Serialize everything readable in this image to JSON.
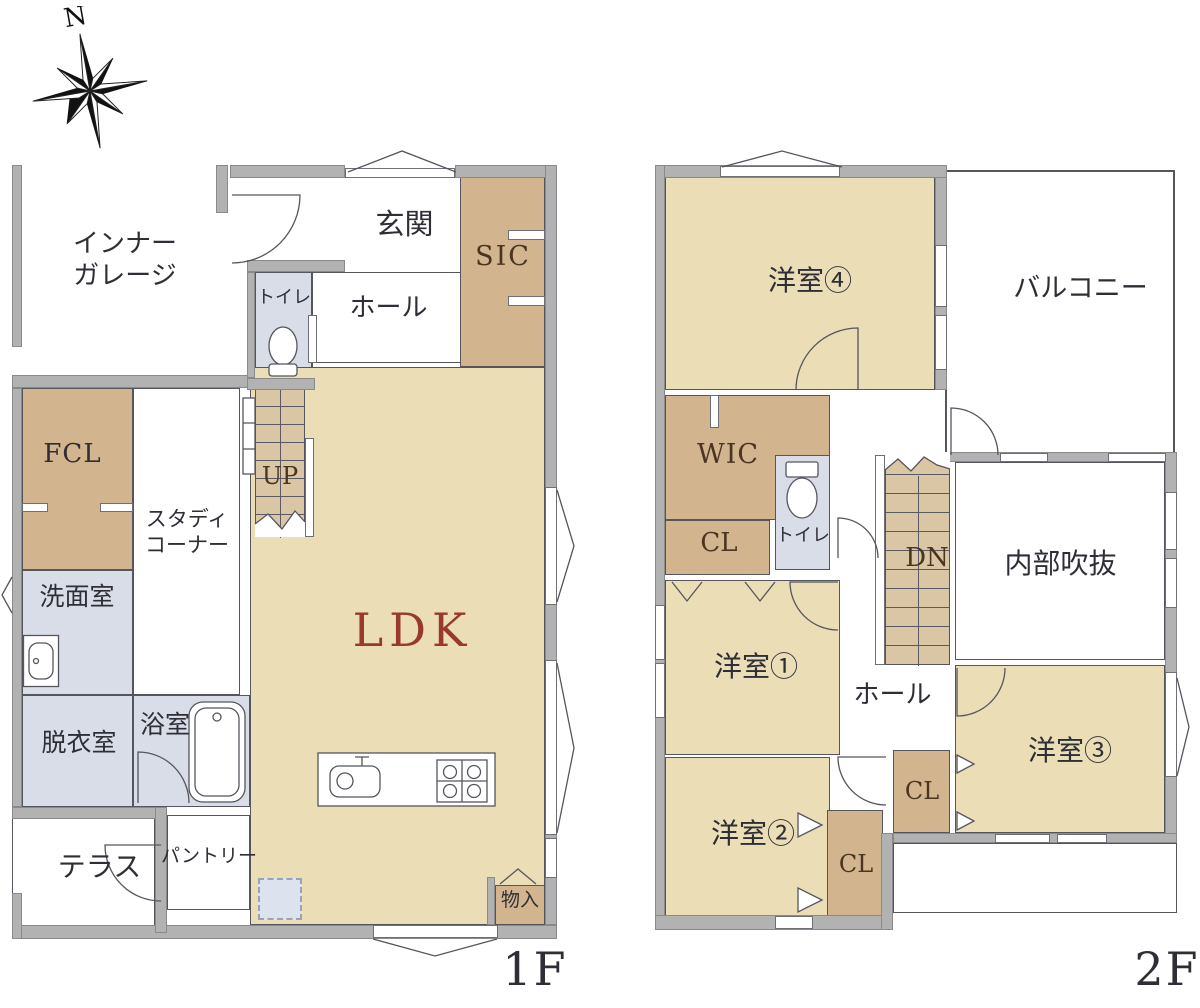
{
  "compass": {
    "north_label": "N"
  },
  "floor1": {
    "name_label": "1F",
    "garage_line1": "インナー",
    "garage_line2": "ガレージ",
    "genkan": "玄関",
    "sic": "SIC",
    "toilet": "トイレ",
    "hall": "ホール",
    "fcl": "FCL",
    "study_line1": "スタディ",
    "study_line2": "コーナー",
    "stairs_up": "UP",
    "washroom": "洗面室",
    "dressing": "脱衣室",
    "bath": "浴室",
    "ldk": "LDK",
    "terrace": "テラス",
    "pantry": "パントリー",
    "storage": "物入"
  },
  "floor2": {
    "name_label": "2F",
    "room4": "洋室④",
    "balcony": "バルコニー",
    "wic": "WIC",
    "closet_a": "CL",
    "toilet": "トイレ",
    "stairs_down": "DN",
    "void": "内部吹抜",
    "room1": "洋室①",
    "hall": "ホール",
    "room3": "洋室③",
    "closet_b": "CL",
    "room2": "洋室②",
    "closet_c": "CL"
  },
  "colors": {
    "floor": "#EBDDB6",
    "closet": "#D2B48E",
    "stairs": "#DAC6A4",
    "wet": "#D8DDE8",
    "wall": "#B2B2B2",
    "line": "#55555E",
    "ldk_text": "#99392C",
    "label": "#2E2E36",
    "closet_label": "#4A3520"
  }
}
